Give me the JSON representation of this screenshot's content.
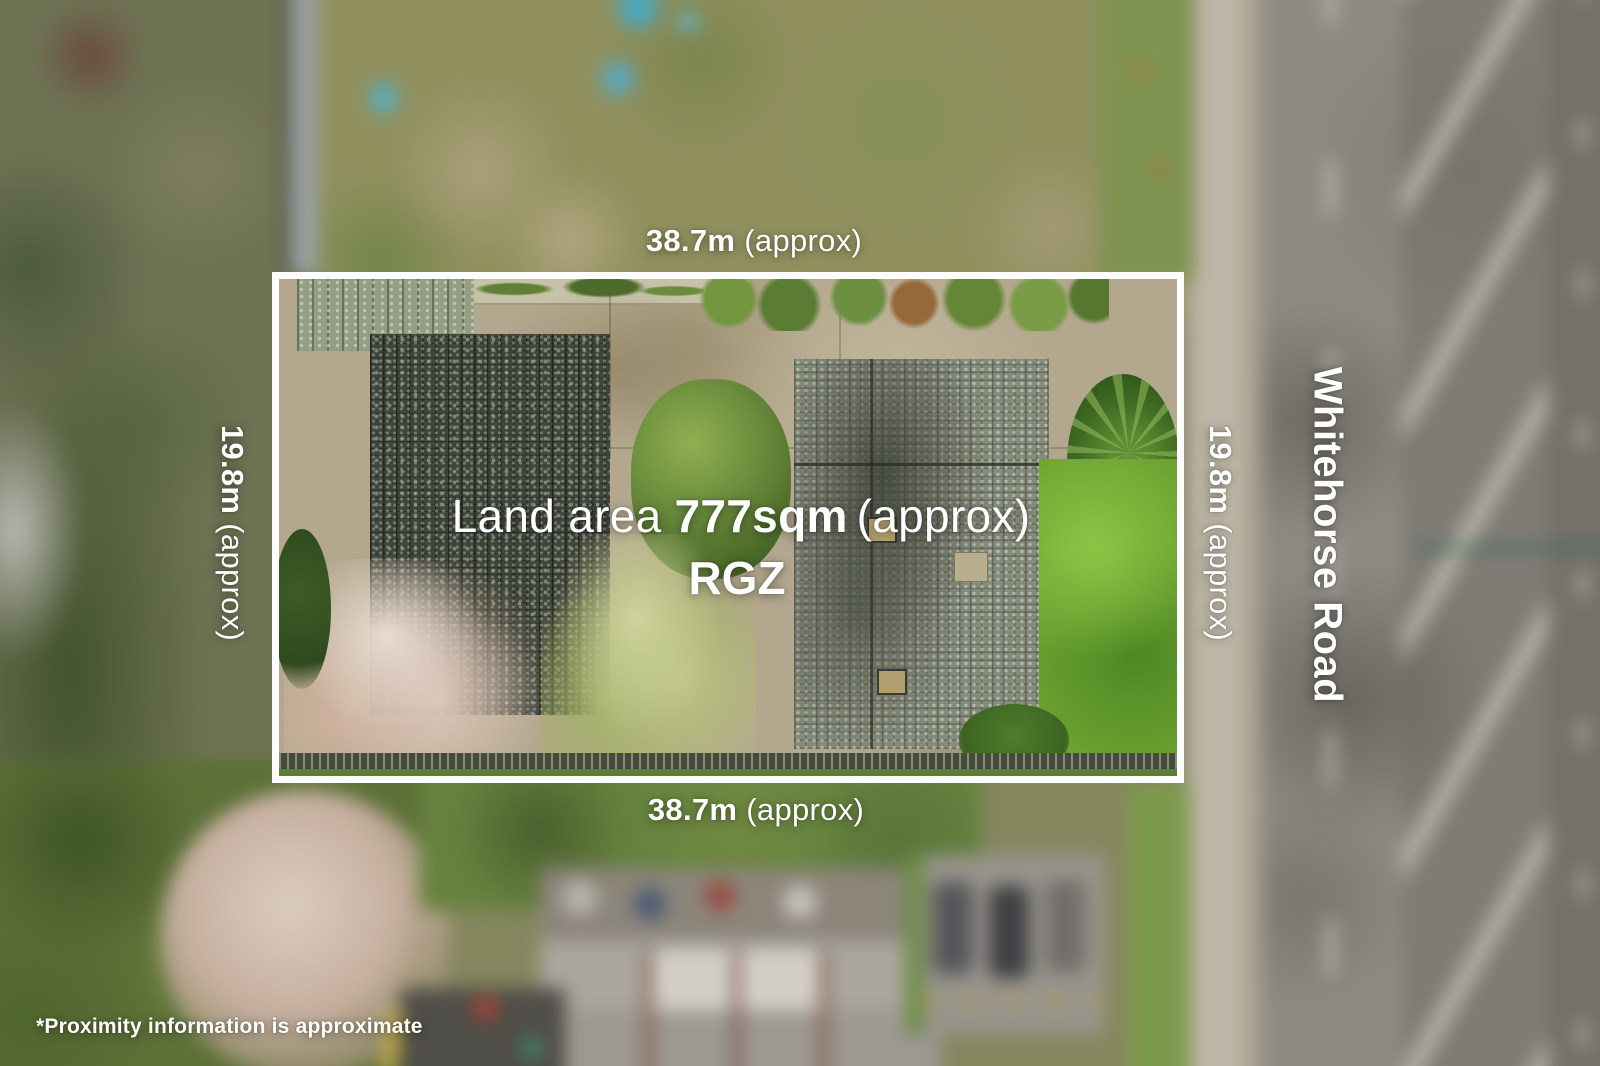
{
  "annotations": {
    "top_boundary": {
      "length": "38.7m",
      "qualifier": "(approx)"
    },
    "bottom_boundary": {
      "length": "38.7m",
      "qualifier": "(approx)"
    },
    "left_boundary": {
      "length": "19.8m",
      "qualifier": "(approx)"
    },
    "right_boundary": {
      "length": "19.8m",
      "qualifier": "(approx)"
    },
    "land_area": {
      "label": "Land area",
      "value": "777sqm",
      "qualifier": "(approx)"
    },
    "zoning_code": "RGZ",
    "road_name": "Whitehorse Road",
    "disclaimer": "*Proximity information is approximate"
  },
  "style": {
    "boundary_color": "#ffffff",
    "label_color": "#ffffff"
  }
}
